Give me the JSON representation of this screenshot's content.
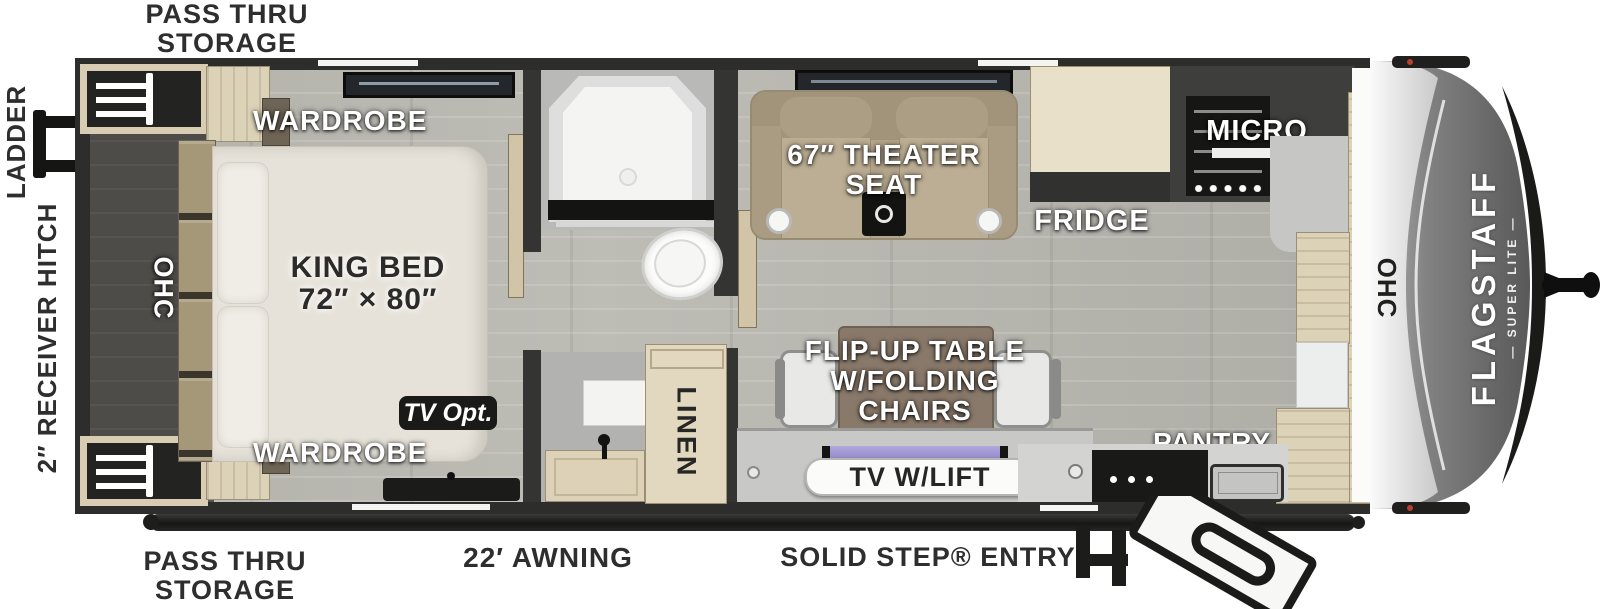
{
  "exterior": {
    "pass_thru_top": [
      "PASS THRU",
      "STORAGE"
    ],
    "pass_thru_bottom": [
      "PASS THRU",
      "STORAGE"
    ],
    "ladder": "LADDER",
    "receiver_hitch": "2″ RECEIVER HITCH",
    "awning": "22′ AWNING",
    "entry": "SOLID STEP® ENTRY"
  },
  "bedroom": {
    "wardrobe_top": "WARDROBE",
    "wardrobe_bottom": "WARDROBE",
    "ohc": "OHC",
    "bed_line1": "KING BED",
    "bed_line2": "72″ × 80″",
    "tv_opt": "TV Opt."
  },
  "bathroom": {
    "linen": "LINEN"
  },
  "living": {
    "theater_line1": "67″ THEATER",
    "theater_line2": "SEAT",
    "table_line1": "FLIP-UP TABLE",
    "table_line2": "W/FOLDING",
    "table_line3": "CHAIRS",
    "tv_lift": "TV W/LIFT"
  },
  "kitchen": {
    "fridge": "FRIDGE",
    "micro": "MICRO",
    "pantry": "PANTRY",
    "ohc": "OHC"
  },
  "brand": {
    "name": "FLAGSTAFF",
    "sub": "— SUPER LITE —"
  },
  "colors": {
    "wall": "#2d2d2b",
    "floor": "#b5b4ad",
    "bedroom_dark": "#4e4c48",
    "wood": "#dcd2b8",
    "bed": "#e6e2d9",
    "theater_seat": "#b4a68c",
    "tv_purple": "#9e94cc",
    "cap_dark": "#6b6b6b",
    "clearance_light": "#b9402e",
    "label_dark": "#2e2e2e",
    "label_white": "#ffffff"
  }
}
